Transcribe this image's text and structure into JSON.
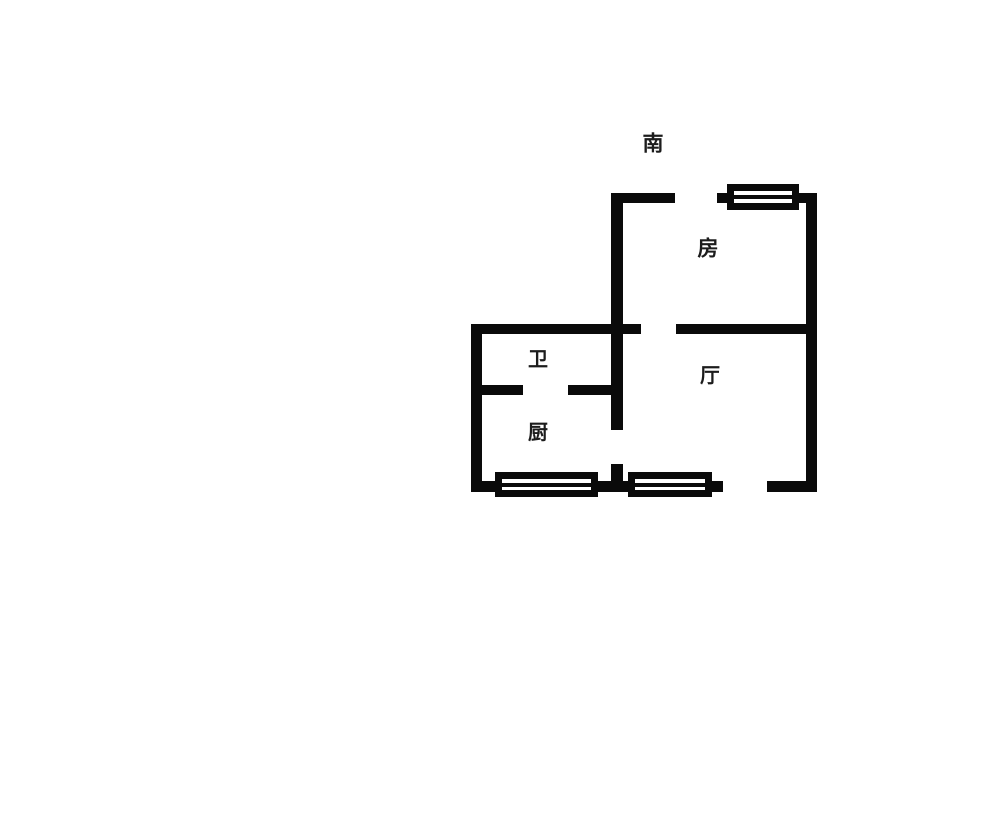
{
  "canvas": {
    "width": 1000,
    "height": 829,
    "background_color": "#ffffff",
    "wall_color": "#0a0a0a",
    "label_color": "#1c1c1c"
  },
  "compass": {
    "label": "南",
    "cx": 653,
    "cy": 144
  },
  "rooms": [
    {
      "id": "bedroom",
      "label": "房",
      "cx": 708,
      "cy": 249
    },
    {
      "id": "bathroom",
      "label": "卫",
      "cx": 538,
      "cy": 359
    },
    {
      "id": "living-room",
      "label": "厅",
      "cx": 710,
      "cy": 375
    },
    {
      "id": "kitchen",
      "label": "厨",
      "cx": 538,
      "cy": 432
    }
  ],
  "plan": {
    "walls": [
      {
        "name": "bedroom-top-wall",
        "x": 611,
        "y": 193,
        "w": 64,
        "h": 10
      },
      {
        "name": "center-vertical-wall",
        "x": 611,
        "y": 193,
        "w": 12,
        "h": 237
      },
      {
        "name": "window-stub-left",
        "x": 717,
        "y": 193,
        "w": 10,
        "h": 10
      },
      {
        "name": "window-stub-right",
        "x": 799,
        "y": 193,
        "w": 10,
        "h": 10
      },
      {
        "name": "right-wall",
        "x": 806,
        "y": 193,
        "w": 11,
        "h": 298
      },
      {
        "name": "middle-wall-left",
        "x": 471,
        "y": 324,
        "w": 170,
        "h": 10
      },
      {
        "name": "middle-wall-right",
        "x": 676,
        "y": 324,
        "w": 130,
        "h": 10
      },
      {
        "name": "left-wall",
        "x": 471,
        "y": 324,
        "w": 11,
        "h": 168
      },
      {
        "name": "bath-divider-left",
        "x": 471,
        "y": 385,
        "w": 52,
        "h": 10
      },
      {
        "name": "bath-divider-right",
        "x": 568,
        "y": 385,
        "w": 43,
        "h": 10
      },
      {
        "name": "kitchen-door-stub",
        "x": 611,
        "y": 464,
        "w": 12,
        "h": 17
      },
      {
        "name": "bottom-wall-left",
        "x": 471,
        "y": 481,
        "w": 28,
        "h": 11
      },
      {
        "name": "bottom-wall-mid",
        "x": 598,
        "y": 481,
        "w": 30,
        "h": 11
      },
      {
        "name": "bottom-wall-right-inner",
        "x": 712,
        "y": 481,
        "w": 11,
        "h": 11
      },
      {
        "name": "bottom-wall-right",
        "x": 767,
        "y": 481,
        "w": 50,
        "h": 11
      }
    ],
    "windows": [
      {
        "name": "bedroom-window",
        "x": 727,
        "y": 184,
        "w": 72,
        "h": 26
      },
      {
        "name": "kitchen-window",
        "x": 495,
        "y": 472,
        "w": 103,
        "h": 25
      },
      {
        "name": "living-window",
        "x": 628,
        "y": 472,
        "w": 84,
        "h": 25
      }
    ]
  }
}
